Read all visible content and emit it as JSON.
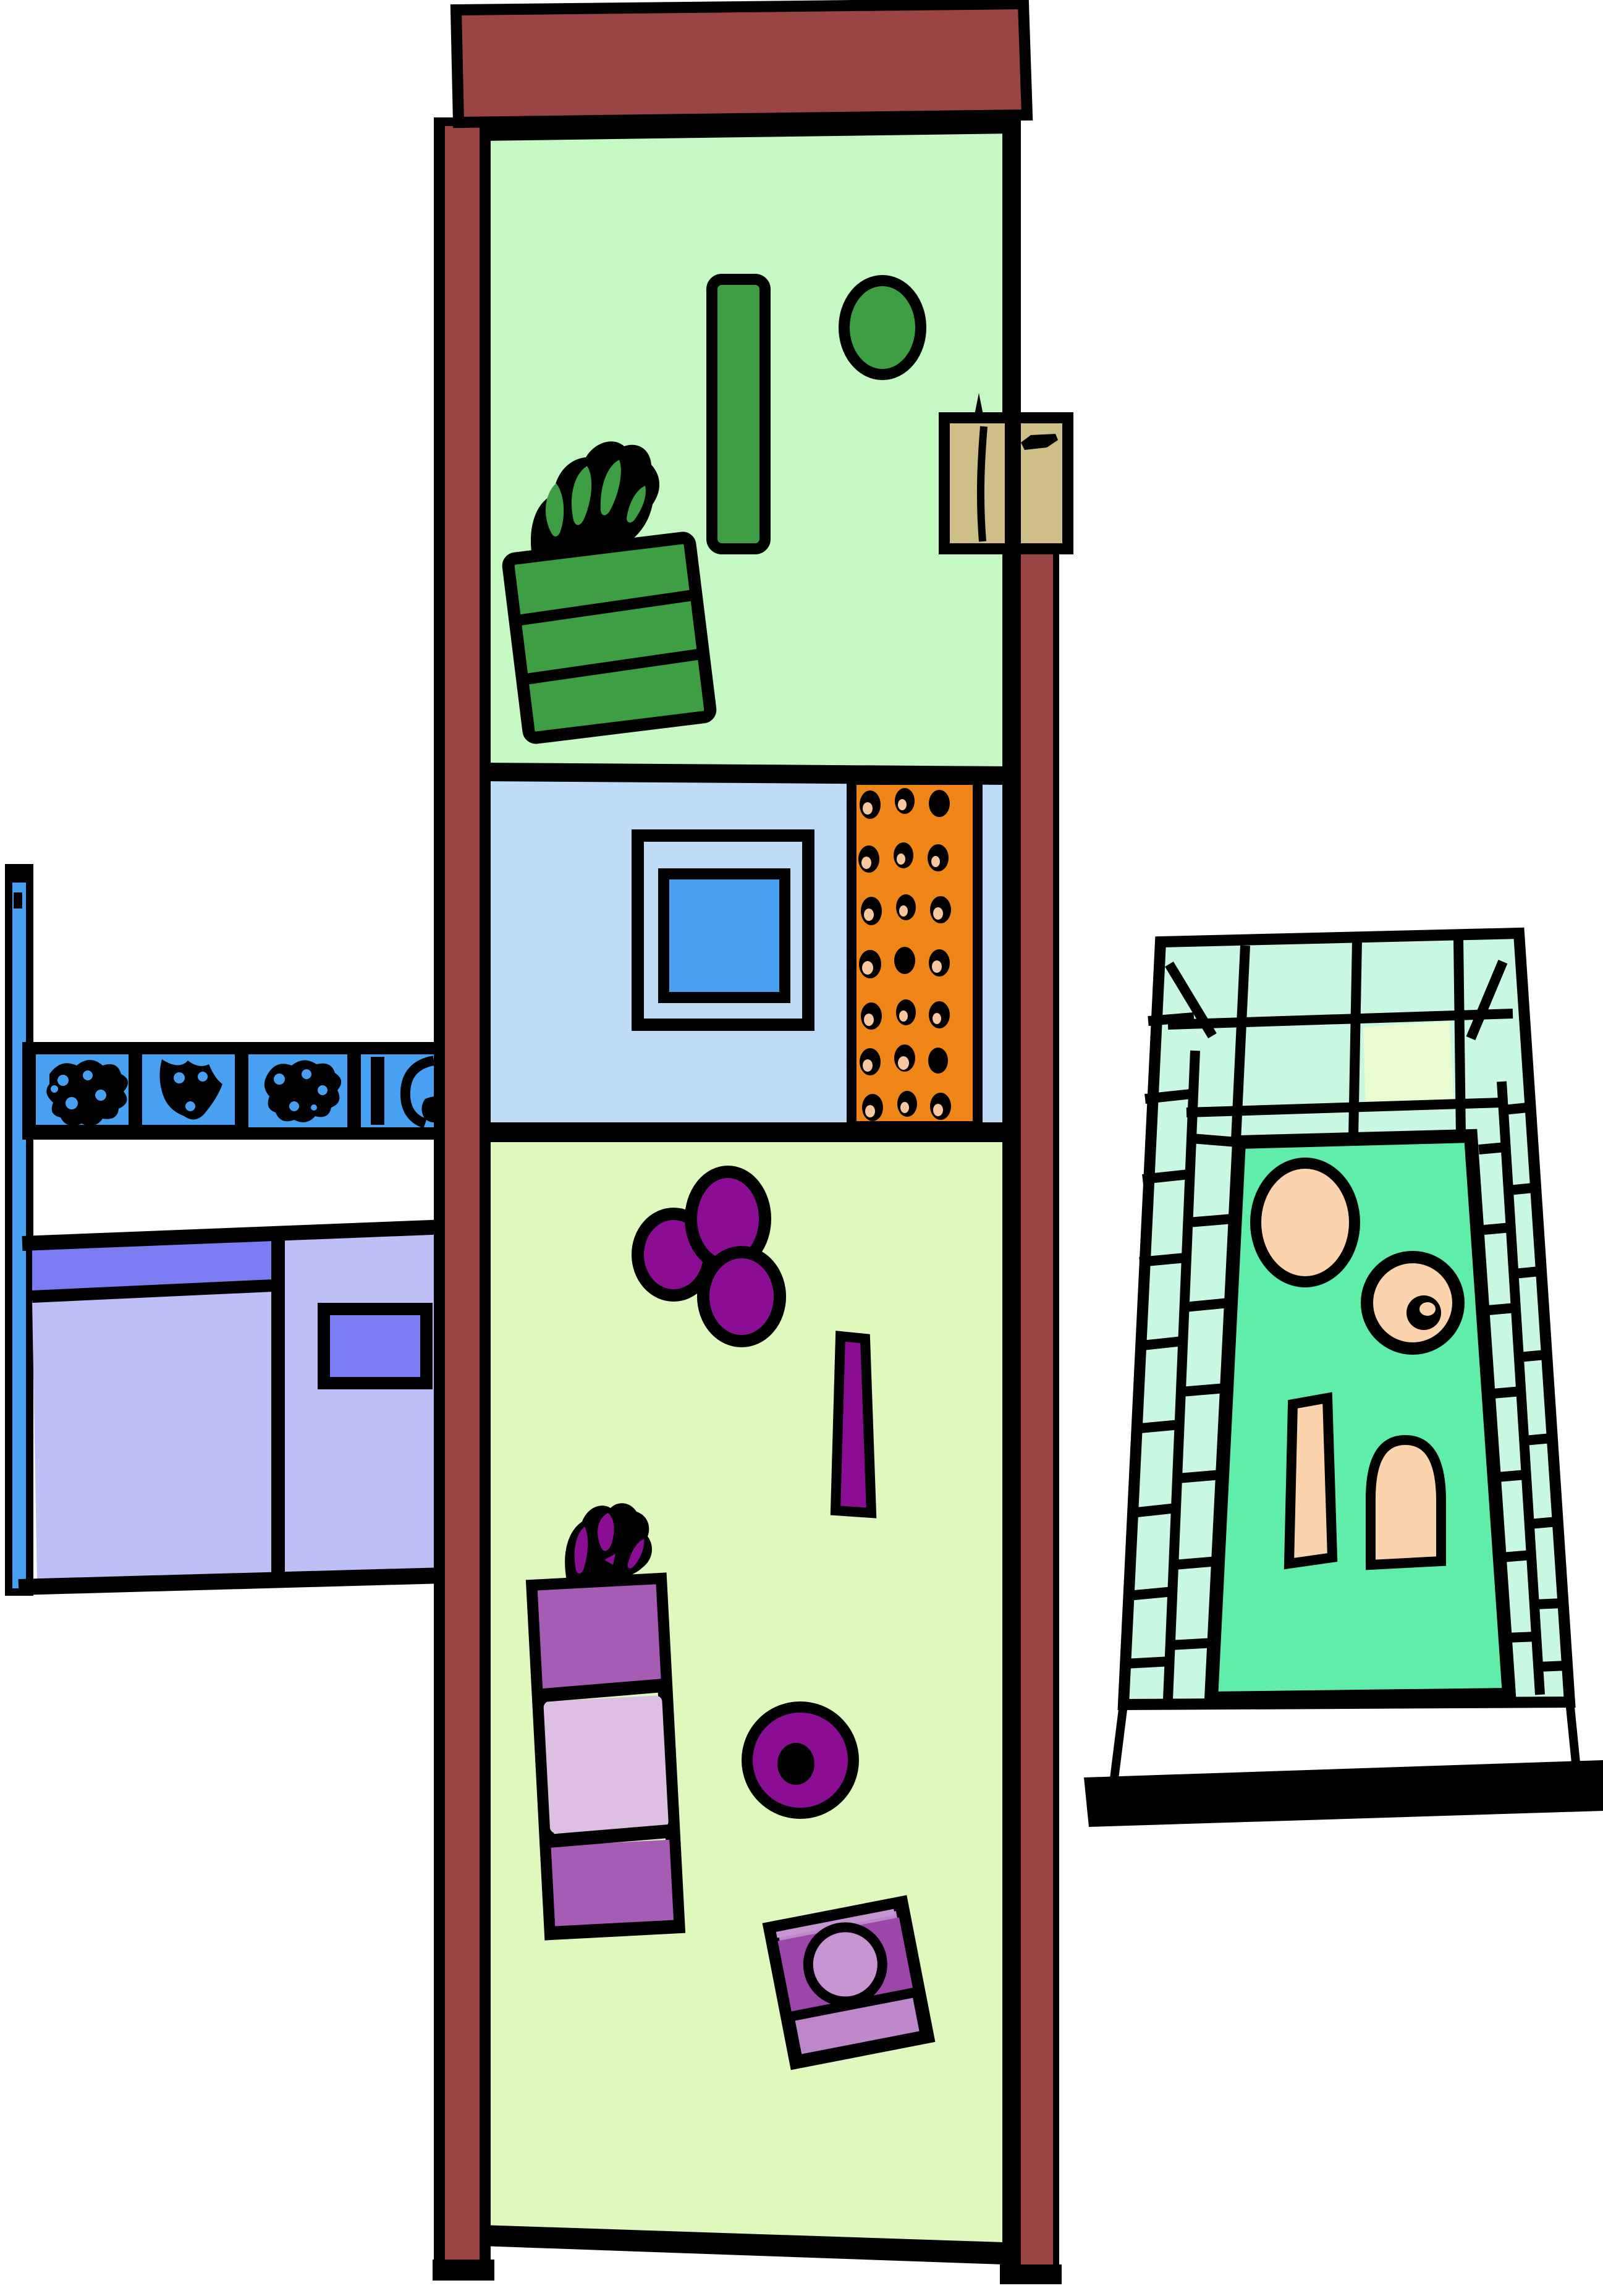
{
  "scene": {
    "type": "clipart-floorplan-illustration",
    "structures": {
      "tower_rooms": 3,
      "orange_panel_dot_rows": 7,
      "orange_panel_dot_cols": 3,
      "left_tile_count": 4
    }
  },
  "colors": {
    "background": "#ffffff",
    "outline": "#000000",
    "roof_red": "#9a4444",
    "room_green_bg": "#c6f8c3",
    "room_blue_bg": "#bfdcf6",
    "room_lime_bg": "#def8bd",
    "object_green": "#3d9e43",
    "tan": "#cdbf87",
    "bright_blue": "#47a0f2",
    "orange": "#f08617",
    "peach_dot": "#f7c89d",
    "purple": "#8a0d94",
    "purple_medium": "#a65cb4",
    "purple_light": "#dcbfe2",
    "machine_top": "#9c46aa",
    "machine_band": "#bd87c9",
    "machine_circle": "#c795d2",
    "lavender": "#bfbff7",
    "violet": "#7c7cf2",
    "pool_mint": "#c8f8e2",
    "pool_green": "#60eda9",
    "pool_peach": "#fbd4ad",
    "pool_tile_yellow": "#e9fbd0"
  }
}
